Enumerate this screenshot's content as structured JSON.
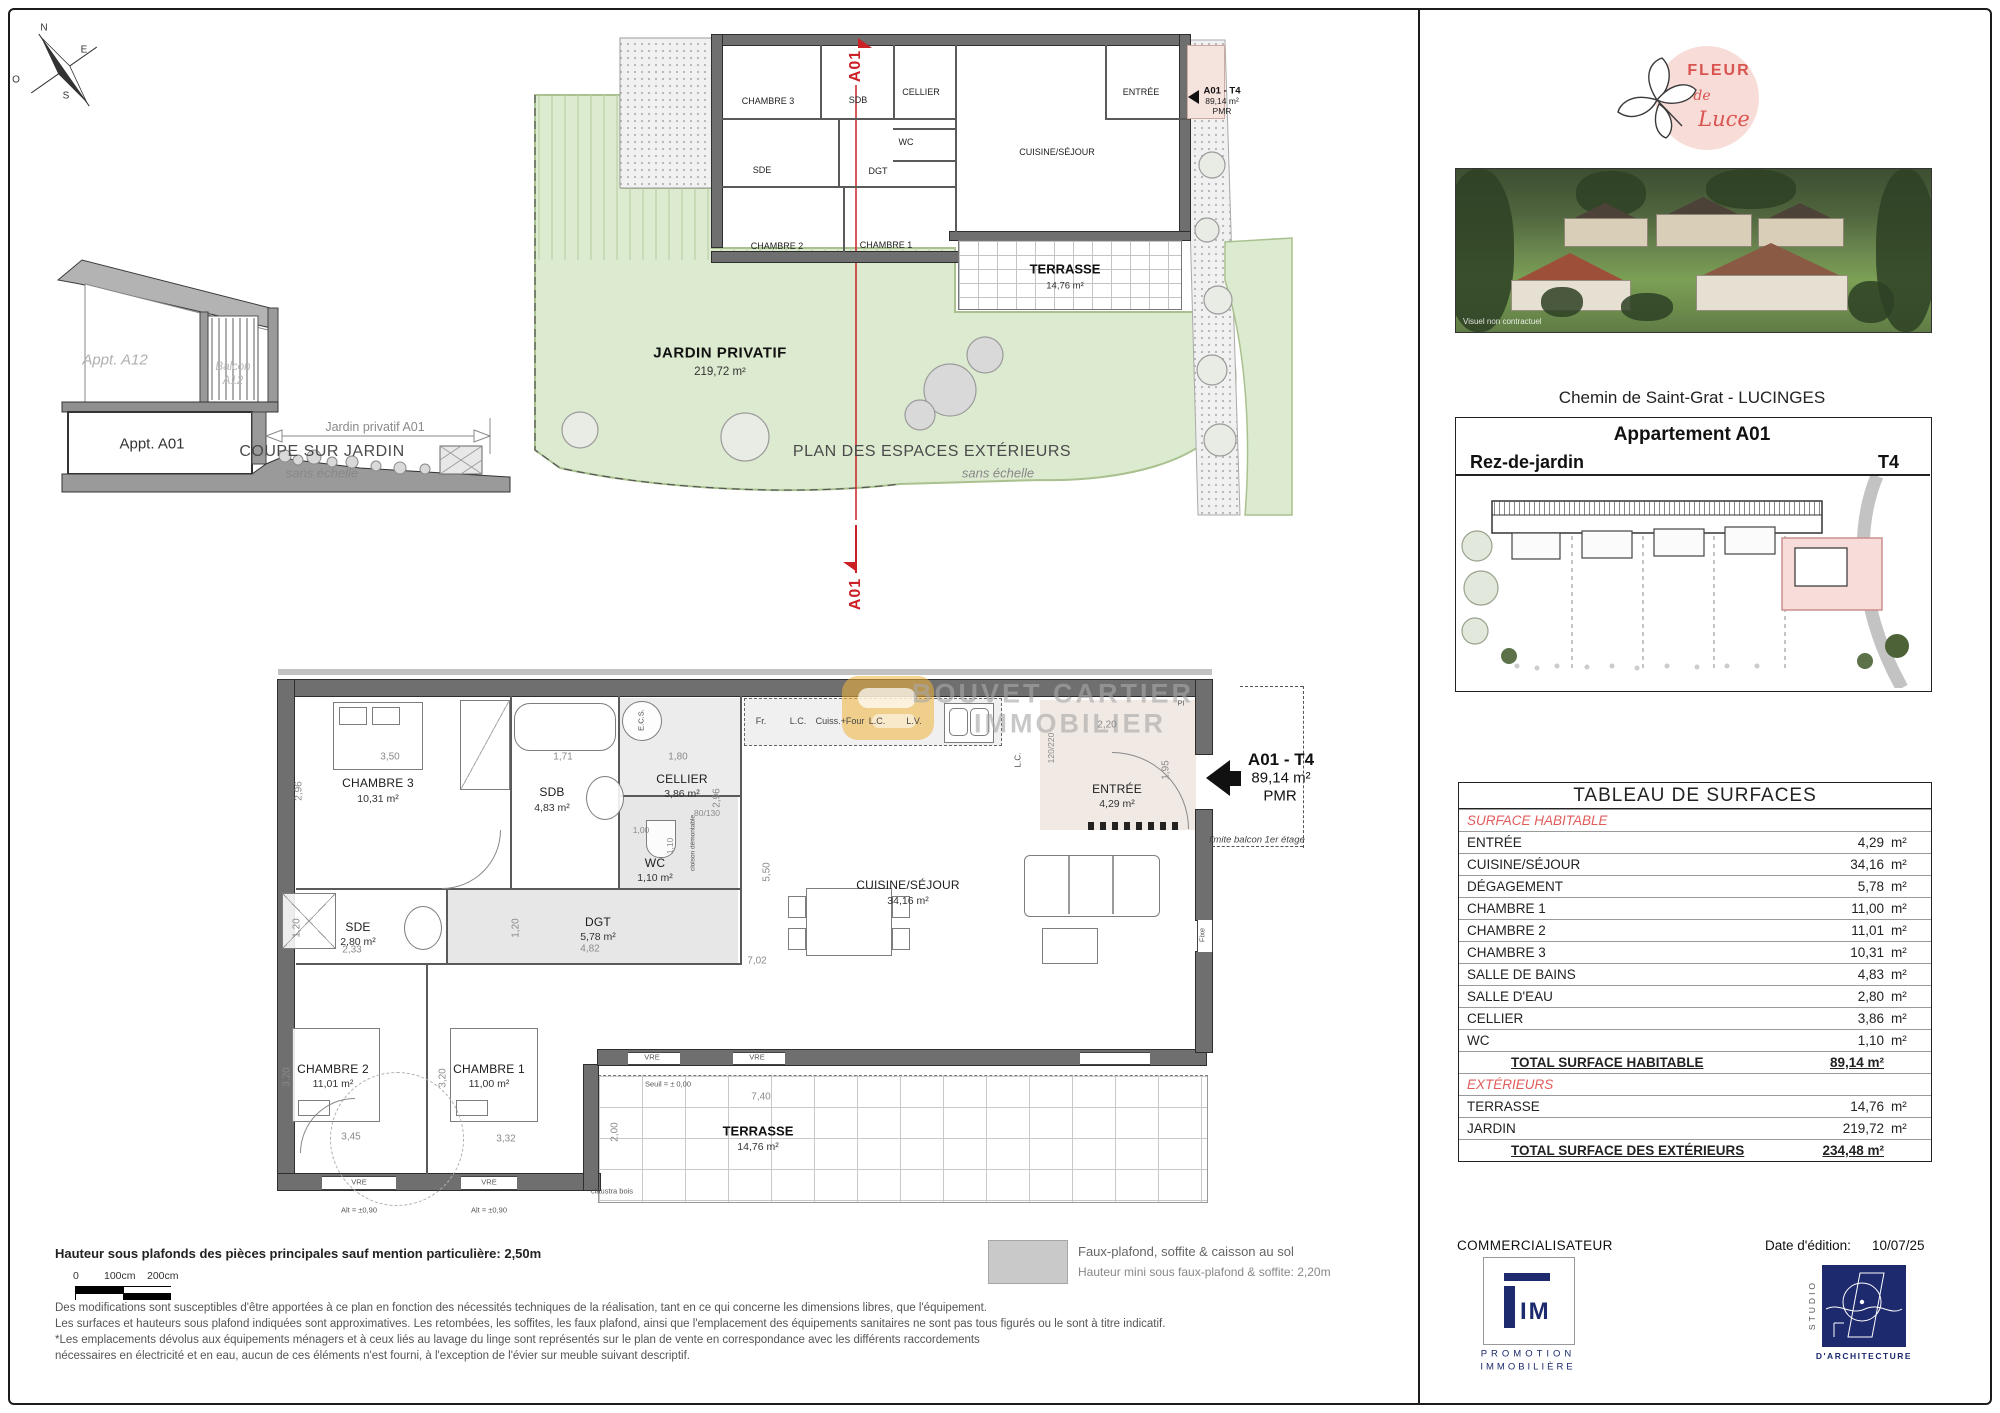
{
  "compass": {
    "n": "N",
    "e": "E",
    "s": "S",
    "o": "O"
  },
  "coupe": {
    "appt_a12": "Appt. A12",
    "balcon_line1": "Balcon",
    "balcon_line2": "A12",
    "appt_a01": "Appt. A01",
    "jardin_dim": "Jardin privatif A01",
    "caption": "COUPE SUR JARDIN",
    "scale_note": "sans échelle"
  },
  "exterior_plan": {
    "caption": "PLAN DES ESPACES EXTÉRIEURS",
    "scale_note": "sans échelle",
    "jardin_title": "JARDIN PRIVATIF",
    "jardin_area": "219,72 m²",
    "section_label": "A01",
    "unit": {
      "code": "A01 - T4",
      "area": "89,14 m²",
      "pmr": "PMR"
    },
    "rooms": {
      "chambre3": "CHAMBRE 3",
      "sdb": "SDB",
      "cellier": "CELLIER",
      "entree": "ENTRÉE",
      "wc": "WC",
      "sde": "SDE",
      "dgt": "DGT",
      "chambre2": "CHAMBRE 2",
      "chambre1": "CHAMBRE 1",
      "cuisine": "CUISINE/SÉJOUR",
      "terrasse": "TERRASSE",
      "terrasse_area": "14,76 m²"
    }
  },
  "main_plan": {
    "watermark_line1": "BOUVET CARTIER",
    "watermark_line2": "IMMOBILIER",
    "unit": {
      "code": "A01 - T4",
      "area": "89,14 m²",
      "pmr": "PMR"
    },
    "limite_balcon": "limite balcon 1er étage",
    "rooms": [
      {
        "name": "CHAMBRE 3",
        "area": "10,31 m²"
      },
      {
        "name": "SDB",
        "area": "4,83 m²"
      },
      {
        "name": "CELLIER",
        "area": "3,86 m²"
      },
      {
        "name": "WC",
        "area": "1,10 m²"
      },
      {
        "name": "SDE",
        "area": "2,80 m²"
      },
      {
        "name": "DGT",
        "area": "5,78 m²"
      },
      {
        "name": "CHAMBRE 2",
        "area": "11,01 m²"
      },
      {
        "name": "CHAMBRE 1",
        "area": "11,00 m²"
      },
      {
        "name": "CUISINE/SÉJOUR",
        "area": "34,16 m²"
      },
      {
        "name": "ENTRÉE",
        "area": "4,29 m²"
      },
      {
        "name": "TERRASSE",
        "area": "14,76 m²"
      }
    ],
    "kitchen": [
      "Fr.",
      "L.C.",
      "Cuiss.+Four",
      "L.C.",
      "L.V."
    ],
    "labels": {
      "ecs": "E.C.S.",
      "pi": "PI",
      "fixe": "Fixe",
      "vre": "VRE",
      "alt": "Alt = ±0,90",
      "seuil": "Seuil = ± 0,00",
      "claustra": "claustra bois",
      "cloison": "cloison démontable",
      "lc": "L.C."
    },
    "dims": [
      "3,50",
      "2,96",
      "1,71",
      "1,80",
      "2,96",
      "80/130",
      "1,00",
      "1,10",
      "1,20",
      "2,33",
      "1,20",
      "4,82",
      "5,50",
      "2,20",
      "1,95",
      "120/220",
      "7,02",
      "3,20",
      "3,20",
      "3,45",
      "3,32",
      "7,40",
      "2,00"
    ]
  },
  "sidebar": {
    "logo": {
      "fleur": "FLEUR",
      "de": "de",
      "luce": "Luce"
    },
    "photo_note": "Visuel non contractuel",
    "address": "Chemin de Saint-Grat - LUCINGES",
    "unit_title": "Appartement A01",
    "level": "Rez-de-jardin",
    "type": "T4",
    "tableau": {
      "title": "TABLEAU DE SURFACES",
      "rows": [
        {
          "label": "SURFACE HABITABLE",
          "value": "",
          "unit": ""
        },
        {
          "label": "ENTRÉE",
          "value": "4,29",
          "unit": "m²"
        },
        {
          "label": "CUISINE/SÉJOUR",
          "value": "34,16",
          "unit": "m²"
        },
        {
          "label": "DÉGAGEMENT",
          "value": "5,78",
          "unit": "m²"
        },
        {
          "label": "CHAMBRE 1",
          "value": "11,00",
          "unit": "m²"
        },
        {
          "label": "CHAMBRE 2",
          "value": "11,01",
          "unit": "m²"
        },
        {
          "label": "CHAMBRE 3",
          "value": "10,31",
          "unit": "m²"
        },
        {
          "label": "SALLE DE BAINS",
          "value": "4,83",
          "unit": "m²"
        },
        {
          "label": "SALLE D'EAU",
          "value": "2,80",
          "unit": "m²"
        },
        {
          "label": "CELLIER",
          "value": "3,86",
          "unit": "m²"
        },
        {
          "label": "WC",
          "value": "1,10",
          "unit": "m²"
        },
        {
          "label": "TOTAL SURFACE HABITABLE",
          "value": "89,14 m²",
          "unit": ""
        },
        {
          "label": "EXTÉRIEURS",
          "value": "",
          "unit": ""
        },
        {
          "label": "TERRASSE",
          "value": "14,76",
          "unit": "m²"
        },
        {
          "label": "JARDIN",
          "value": "219,72",
          "unit": "m²"
        },
        {
          "label": "TOTAL SURFACE DES EXTÉRIEURS",
          "value": "234,48 m²",
          "unit": ""
        }
      ]
    },
    "commercialisateur": "COMMERCIALISATEUR",
    "fim": {
      "name": "IM",
      "line1": "PROMOTION",
      "line2": "IMMOBILIÈRE"
    },
    "date_label": "Date d'édition:",
    "date_value": "10/07/25",
    "studio": {
      "vertical": "STUDIO",
      "bottom": "D'ARCHITECTURE"
    }
  },
  "footer": {
    "hauteur_note": "Hauteur sous plafonds des pièces principales sauf mention particulière: 2,50m",
    "scale": {
      "zero": "0",
      "c100": "100cm",
      "c200": "200cm"
    },
    "legend_line1": "Faux-plafond, soffite & caisson au sol",
    "legend_line2": "Hauteur mini sous faux-plafond & soffite: 2,20m",
    "disclaimer": [
      "Des modifications sont susceptibles d'être apportées à ce plan en fonction des nécessités techniques de la réalisation, tant en ce qui concerne les dimensions libres, que l'équipement.",
      "Les surfaces et hauteurs sous plafond indiquées sont approximatives. Les retombées, les soffites, les faux plafond, ainsi que l'emplacement des équipements sanitaires ne sont pas tous figurés ou le sont à titre indicatif.",
      "*Les emplacements dévolus aux équipements ménagers et à ceux liés au lavage du linge sont représentés sur le plan de vente en correspondance avec les différents raccordements",
      "nécessaires en électricité et en eau, aucun de ces éléments n'est fourni, à l'exception de l'évier sur meuble suivant descriptif."
    ]
  },
  "colors": {
    "accent_red": "#e05c5c",
    "section_red": "#cc2027",
    "logo_pink": "#f8dcd8",
    "navy": "#1d2a6e",
    "garden_green": "#dcead0",
    "wall_gray": "#6f6f6f",
    "watermark_yellow": "#f0b429"
  }
}
